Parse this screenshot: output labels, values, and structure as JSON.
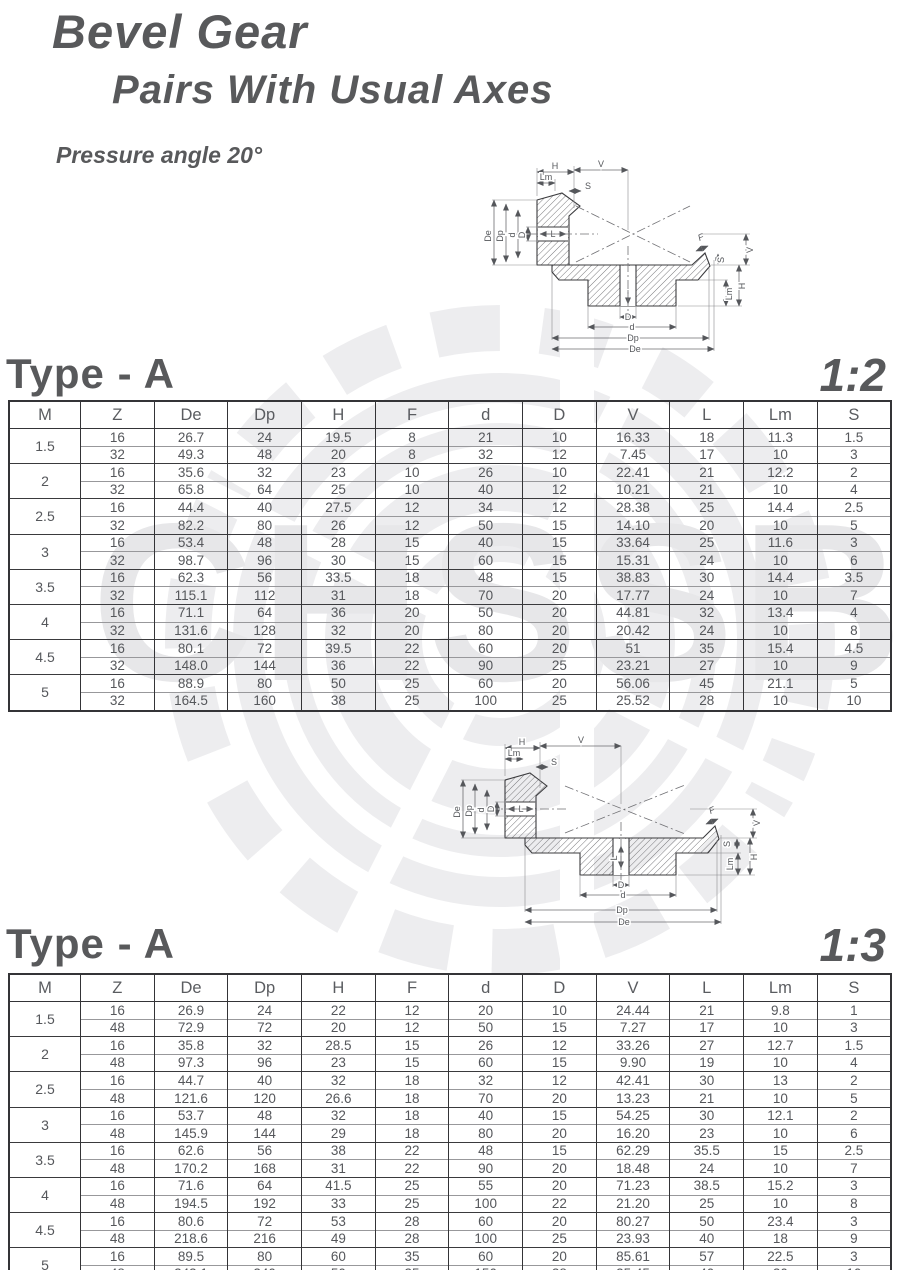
{
  "page": {
    "title_line1": "Bevel Gear",
    "title_line2": "Pairs With Usual Axes",
    "subtitle": "Pressure angle 20°"
  },
  "watermark_text": "CHSSB",
  "diagram_labels": {
    "h": "H",
    "lm": "Lm",
    "s": "S",
    "v": "V",
    "de": "De",
    "dp": "Dp",
    "d_small": "d",
    "d_cap": "D",
    "f": "F",
    "l": "L"
  },
  "sections": [
    {
      "type_label": "Type - A",
      "ratio": "1:2",
      "columns": [
        "M",
        "Z",
        "De",
        "Dp",
        "H",
        "F",
        "d",
        "D",
        "V",
        "L",
        "Lm",
        "S"
      ],
      "groups": [
        {
          "m": "1.5",
          "rows": [
            [
              "16",
              "26.7",
              "24",
              "19.5",
              "8",
              "21",
              "10",
              "16.33",
              "18",
              "11.3",
              "1.5"
            ],
            [
              "32",
              "49.3",
              "48",
              "20",
              "8",
              "32",
              "12",
              "7.45",
              "17",
              "10",
              "3"
            ]
          ]
        },
        {
          "m": "2",
          "rows": [
            [
              "16",
              "35.6",
              "32",
              "23",
              "10",
              "26",
              "10",
              "22.41",
              "21",
              "12.2",
              "2"
            ],
            [
              "32",
              "65.8",
              "64",
              "25",
              "10",
              "40",
              "12",
              "10.21",
              "21",
              "10",
              "4"
            ]
          ]
        },
        {
          "m": "2.5",
          "rows": [
            [
              "16",
              "44.4",
              "40",
              "27.5",
              "12",
              "34",
              "12",
              "28.38",
              "25",
              "14.4",
              "2.5"
            ],
            [
              "32",
              "82.2",
              "80",
              "26",
              "12",
              "50",
              "15",
              "14.10",
              "20",
              "10",
              "5"
            ]
          ]
        },
        {
          "m": "3",
          "rows": [
            [
              "16",
              "53.4",
              "48",
              "28",
              "15",
              "40",
              "15",
              "33.64",
              "25",
              "11.6",
              "3"
            ],
            [
              "32",
              "98.7",
              "96",
              "30",
              "15",
              "60",
              "15",
              "15.31",
              "24",
              "10",
              "6"
            ]
          ]
        },
        {
          "m": "3.5",
          "rows": [
            [
              "16",
              "62.3",
              "56",
              "33.5",
              "18",
              "48",
              "15",
              "38.83",
              "30",
              "14.4",
              "3.5"
            ],
            [
              "32",
              "115.1",
              "112",
              "31",
              "18",
              "70",
              "20",
              "17.77",
              "24",
              "10",
              "7"
            ]
          ]
        },
        {
          "m": "4",
          "rows": [
            [
              "16",
              "71.1",
              "64",
              "36",
              "20",
              "50",
              "20",
              "44.81",
              "32",
              "13.4",
              "4"
            ],
            [
              "32",
              "131.6",
              "128",
              "32",
              "20",
              "80",
              "20",
              "20.42",
              "24",
              "10",
              "8"
            ]
          ]
        },
        {
          "m": "4.5",
          "rows": [
            [
              "16",
              "80.1",
              "72",
              "39.5",
              "22",
              "60",
              "20",
              "51",
              "35",
              "15.4",
              "4.5"
            ],
            [
              "32",
              "148.0",
              "144",
              "36",
              "22",
              "90",
              "25",
              "23.21",
              "27",
              "10",
              "9"
            ]
          ]
        },
        {
          "m": "5",
          "rows": [
            [
              "16",
              "88.9",
              "80",
              "50",
              "25",
              "60",
              "20",
              "56.06",
              "45",
              "21.1",
              "5"
            ],
            [
              "32",
              "164.5",
              "160",
              "38",
              "25",
              "100",
              "25",
              "25.52",
              "28",
              "10",
              "10"
            ]
          ]
        }
      ]
    },
    {
      "type_label": "Type - A",
      "ratio": "1:3",
      "columns": [
        "M",
        "Z",
        "De",
        "Dp",
        "H",
        "F",
        "d",
        "D",
        "V",
        "L",
        "Lm",
        "S"
      ],
      "groups": [
        {
          "m": "1.5",
          "rows": [
            [
              "16",
              "26.9",
              "24",
              "22",
              "12",
              "20",
              "10",
              "24.44",
              "21",
              "9.8",
              "1"
            ],
            [
              "48",
              "72.9",
              "72",
              "20",
              "12",
              "50",
              "15",
              "7.27",
              "17",
              "10",
              "3"
            ]
          ]
        },
        {
          "m": "2",
          "rows": [
            [
              "16",
              "35.8",
              "32",
              "28.5",
              "15",
              "26",
              "12",
              "33.26",
              "27",
              "12.7",
              "1.5"
            ],
            [
              "48",
              "97.3",
              "96",
              "23",
              "15",
              "60",
              "15",
              "9.90",
              "19",
              "10",
              "4"
            ]
          ]
        },
        {
          "m": "2.5",
          "rows": [
            [
              "16",
              "44.7",
              "40",
              "32",
              "18",
              "32",
              "12",
              "42.41",
              "30",
              "13",
              "2"
            ],
            [
              "48",
              "121.6",
              "120",
              "26.6",
              "18",
              "70",
              "20",
              "13.23",
              "21",
              "10",
              "5"
            ]
          ]
        },
        {
          "m": "3",
          "rows": [
            [
              "16",
              "53.7",
              "48",
              "32",
              "18",
              "40",
              "15",
              "54.25",
              "30",
              "12.1",
              "2"
            ],
            [
              "48",
              "145.9",
              "144",
              "29",
              "18",
              "80",
              "20",
              "16.20",
              "23",
              "10",
              "6"
            ]
          ]
        },
        {
          "m": "3.5",
          "rows": [
            [
              "16",
              "62.6",
              "56",
              "38",
              "22",
              "48",
              "15",
              "62.29",
              "35.5",
              "15",
              "2.5"
            ],
            [
              "48",
              "170.2",
              "168",
              "31",
              "22",
              "90",
              "20",
              "18.48",
              "24",
              "10",
              "7"
            ]
          ]
        },
        {
          "m": "4",
          "rows": [
            [
              "16",
              "71.6",
              "64",
              "41.5",
              "25",
              "55",
              "20",
              "71.23",
              "38.5",
              "15.2",
              "3"
            ],
            [
              "48",
              "194.5",
              "192",
              "33",
              "25",
              "100",
              "22",
              "21.20",
              "25",
              "10",
              "8"
            ]
          ]
        },
        {
          "m": "4.5",
          "rows": [
            [
              "16",
              "80.6",
              "72",
              "53",
              "28",
              "60",
              "20",
              "80.27",
              "50",
              "23.4",
              "3"
            ],
            [
              "48",
              "218.6",
              "216",
              "49",
              "28",
              "100",
              "25",
              "23.93",
              "40",
              "18",
              "9"
            ]
          ]
        },
        {
          "m": "5",
          "rows": [
            [
              "16",
              "89.5",
              "80",
              "60",
              "35",
              "60",
              "20",
              "85.61",
              "57",
              "22.5",
              "3"
            ],
            [
              "48",
              "243.1",
              "240",
              "50",
              "35",
              "150",
              "28",
              "25.45",
              "40",
              "20",
              "10"
            ]
          ]
        }
      ]
    }
  ]
}
